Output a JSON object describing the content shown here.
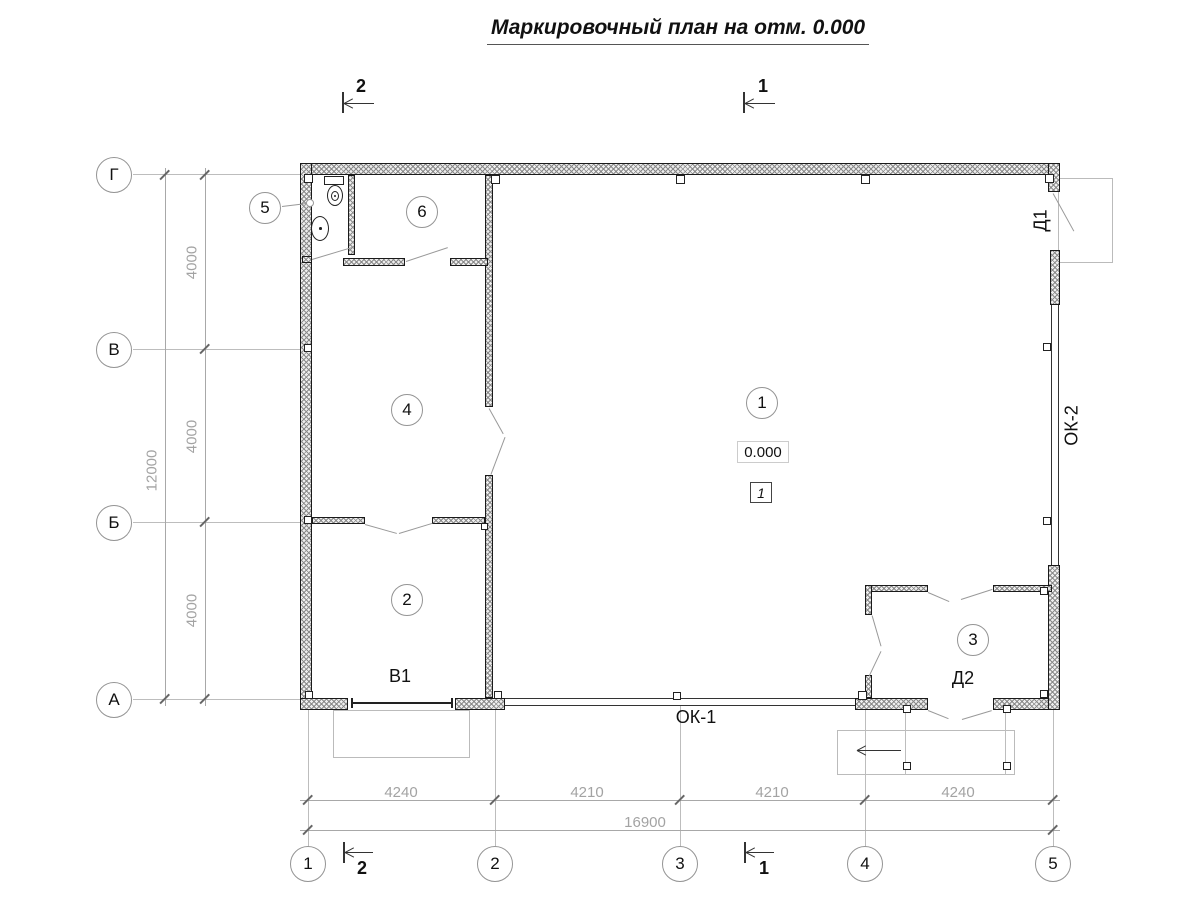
{
  "title": "Маркировочный план на отм. 0.000",
  "section_markers": {
    "top_left": "2",
    "top_right": "1",
    "bottom_left": "2",
    "bottom_right": "1"
  },
  "axes": {
    "horizontal": [
      "Г",
      "В",
      "Б",
      "А"
    ],
    "vertical": [
      "1",
      "2",
      "3",
      "4",
      "5"
    ]
  },
  "dimensions": {
    "left_segments": [
      "4000",
      "4000",
      "4000"
    ],
    "left_total": "12000",
    "bottom_segments": [
      "4240",
      "4210",
      "4210",
      "4240"
    ],
    "bottom_total": "16900"
  },
  "rooms": [
    "1",
    "2",
    "3",
    "4",
    "5",
    "6"
  ],
  "labels": {
    "door1": "Д1",
    "door2": "Д2",
    "window1": "ОК-1",
    "window2": "ОК-2",
    "gate": "В1",
    "elevation": "0.000",
    "floor_type": "1"
  },
  "colors": {
    "ink": "#1a1a1a",
    "dim_text": "#a3a3a3",
    "axis_line": "#bdbdbd",
    "swing_line": "#999999"
  }
}
